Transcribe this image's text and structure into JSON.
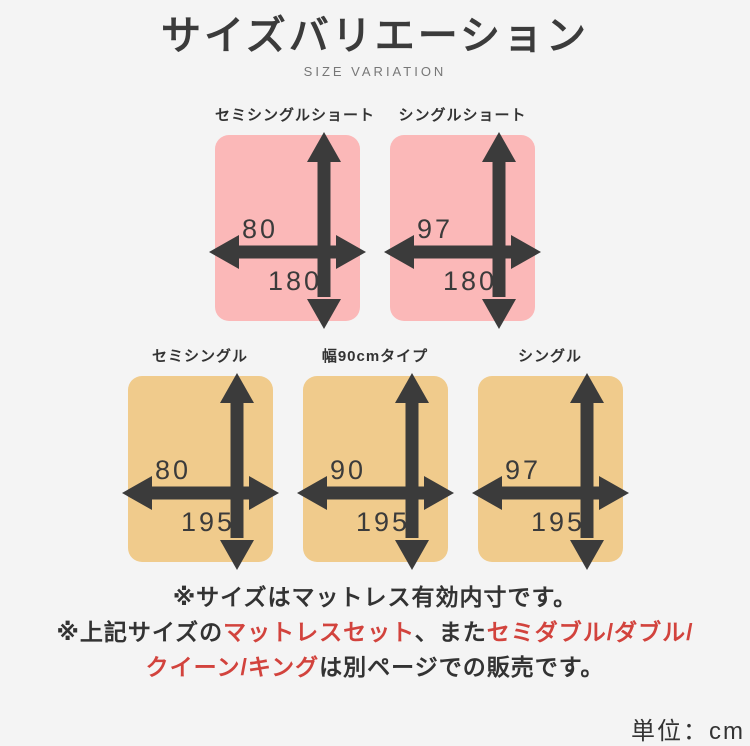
{
  "header": {
    "title": "サイズバリエーション",
    "subtitle": "SIZE VARIATION"
  },
  "colors": {
    "bg": "#f4f4f4",
    "pink": "#fbb8b8",
    "tan": "#f0cb8c",
    "arrow": "#3b3b3b",
    "red": "#d2433d"
  },
  "rows": [
    {
      "panels": [
        {
          "label": "セミシングルショート",
          "width_cm": "80",
          "height_cm": "180",
          "fill": "pink"
        },
        {
          "label": "シングルショート",
          "width_cm": "97",
          "height_cm": "180",
          "fill": "pink"
        }
      ]
    },
    {
      "panels": [
        {
          "label": "セミシングル",
          "width_cm": "80",
          "height_cm": "195",
          "fill": "tan"
        },
        {
          "label": "幅90cmタイプ",
          "width_cm": "90",
          "height_cm": "195",
          "fill": "tan"
        },
        {
          "label": "シングル",
          "width_cm": "97",
          "height_cm": "195",
          "fill": "tan"
        }
      ]
    }
  ],
  "notes": {
    "line1": "※サイズはマットレス有効内寸です。",
    "line2_segments": [
      {
        "text": "※上記サイズの",
        "red": false
      },
      {
        "text": "マットレスセット",
        "red": true
      },
      {
        "text": "、また",
        "red": false
      },
      {
        "text": "セミダブル/ダブル/",
        "red": true
      }
    ],
    "line3_segments": [
      {
        "text": "クイーン/キング",
        "red": true
      },
      {
        "text": "は別ページでの販売です。",
        "red": false
      }
    ]
  },
  "footer": {
    "unit_label": "単位：cm"
  }
}
